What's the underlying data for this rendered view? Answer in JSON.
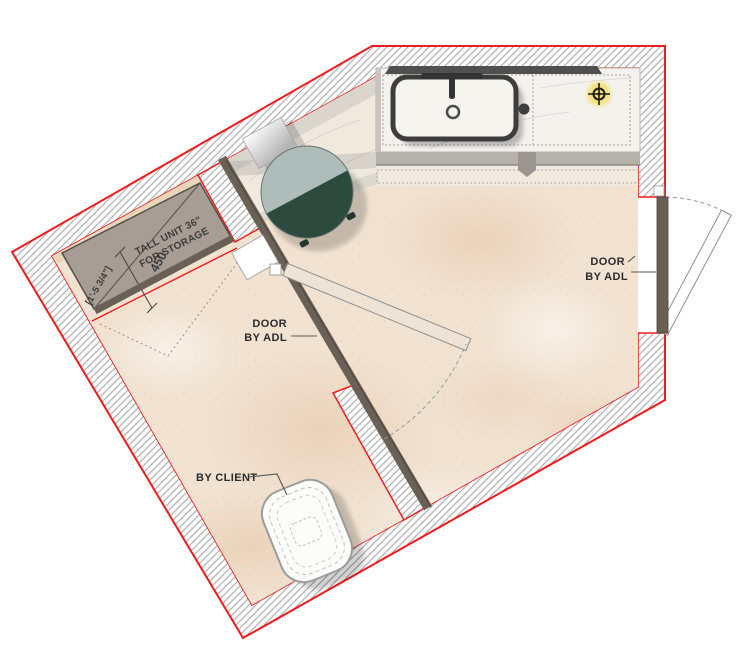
{
  "plan": {
    "labels": {
      "tall_unit_line1": "TALL UNIT 36\"",
      "tall_unit_line2": "FOR STORAGE",
      "dimension_mm": "450",
      "dimension_imperial": "[1'-5 3/4\"]",
      "door_left_line1": "DOOR",
      "door_left_line2": "BY ADL",
      "door_right_line1": "DOOR",
      "door_right_line2": "BY ADL",
      "fixture_note": "BY CLIENT"
    },
    "icons": {
      "reference_marker": "crosshair-target-icon",
      "drain": "drain-circle-icon",
      "faucet": "faucet-icon"
    },
    "colors": {
      "wall_outline": "#ee1c1c",
      "partition_wall": "#6b6056",
      "table_dark": "#2d4a3e",
      "table_light": "#aebdba",
      "floor_beige": "#f1e2d1",
      "counter_marble": "#f4f2ed",
      "marker_glow": "#f3df72",
      "tall_unit_fill": "#a79d94"
    }
  }
}
